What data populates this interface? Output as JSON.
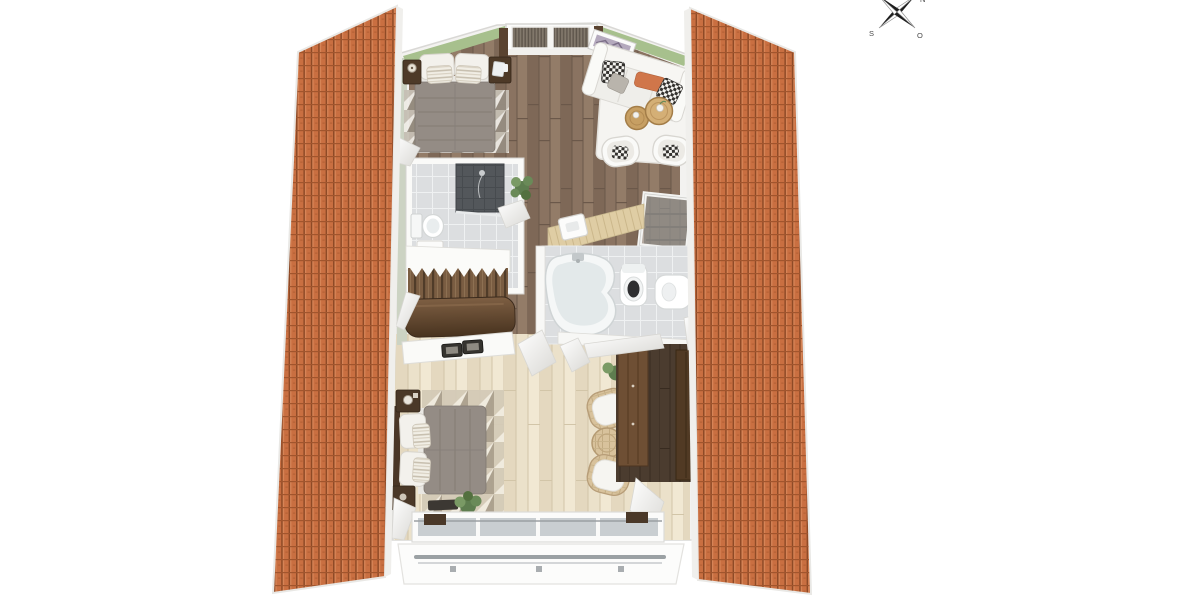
{
  "image": {
    "type": "3d-floor-plan-render",
    "description": "Top-down 3D floor plan of an attic storey between two pitched clay-tile roof panels",
    "background": "#ffffff"
  },
  "compass": {
    "north": "N",
    "east": "O",
    "south": "S",
    "west": "W"
  },
  "palette": {
    "roof_tile": "#c96f41",
    "roof_gap": "#8e4a26",
    "wall_green": "#a7c08d",
    "wall_sage": "#ccd3c3",
    "wall_white": "#f6f5f3",
    "floor_dark_wood": "#8a7361",
    "floor_light_wood": "#ebe1ca",
    "tile_light": "#dcdee0",
    "tile_shower": "#53575b",
    "duvet_gray": "#948c85",
    "furniture_brown": "#4e3a28",
    "balustrade_brown": "#5d4430",
    "accent_orange": "#d0764a",
    "rail_gray": "#9ba1a4",
    "rug_white": "#f5f4f1",
    "wicker_tan": "#d8c29c"
  },
  "roof": {
    "left_panel": "clay-tile roof slope",
    "right_panel": "clay-tile roof slope"
  },
  "rooms": [
    {
      "id": "bedroom-1",
      "label": "Bedroom (top left)",
      "floor": "dark wood planks",
      "furniture": [
        "double bed with gray duvet",
        "white pillows and striped cushions",
        "two dark nightstands",
        "table lamp",
        "triangle-pattern rug",
        "lattice window with dark blinds"
      ]
    },
    {
      "id": "lounge",
      "label": "Sitting area (top right)",
      "floor": "dark wood planks",
      "furniture": [
        "white sofa",
        "checkered pillows",
        "orange lumbar pillow",
        "white rug",
        "two round wooden side tables",
        "two white tub chairs",
        "framed picture on green wall"
      ]
    },
    {
      "id": "shower-room",
      "label": "Shower room / WC",
      "floor": "light gray tile",
      "furniture": [
        "dark tiled shower",
        "toilet with cistern",
        "white cabinet",
        "potted plant by the door"
      ]
    },
    {
      "id": "stair-hall",
      "label": "Landing with staircase",
      "floor": "dark wood planks",
      "furniture": [
        "staircase with wood treads",
        "dark wood balustrade",
        "glass railing panels",
        "stairwell opening",
        "light wood half-wall counter"
      ]
    },
    {
      "id": "bathroom",
      "label": "Bathroom",
      "floor": "light gray tile",
      "furniture": [
        "corner bathtub",
        "wall-hung toilet",
        "bidet"
      ]
    },
    {
      "id": "bedroom-2",
      "label": "Bedroom (bottom)",
      "floor": "whitewashed light wood",
      "furniture": [
        "double bed with gray duvet",
        "two dark nightstands",
        "table lamp",
        "triangle-pattern rug",
        "white sideboard with two dark trays",
        "dark bench",
        "potted plant at window"
      ]
    },
    {
      "id": "reading-nook",
      "label": "Reading nook (bottom right)",
      "furniture": [
        "two wicker armchairs with white cushions",
        "round wicker side table",
        "potted plant"
      ]
    },
    {
      "id": "wardrobe-corner",
      "label": "Wardrobe corner",
      "floor": "dark wood planks",
      "furniture": [
        "two tall brown wardrobes"
      ]
    },
    {
      "id": "balcony",
      "label": "Balcony front",
      "furniture": [
        "four-pane window band",
        "gray metal railing on white parapet"
      ]
    }
  ]
}
